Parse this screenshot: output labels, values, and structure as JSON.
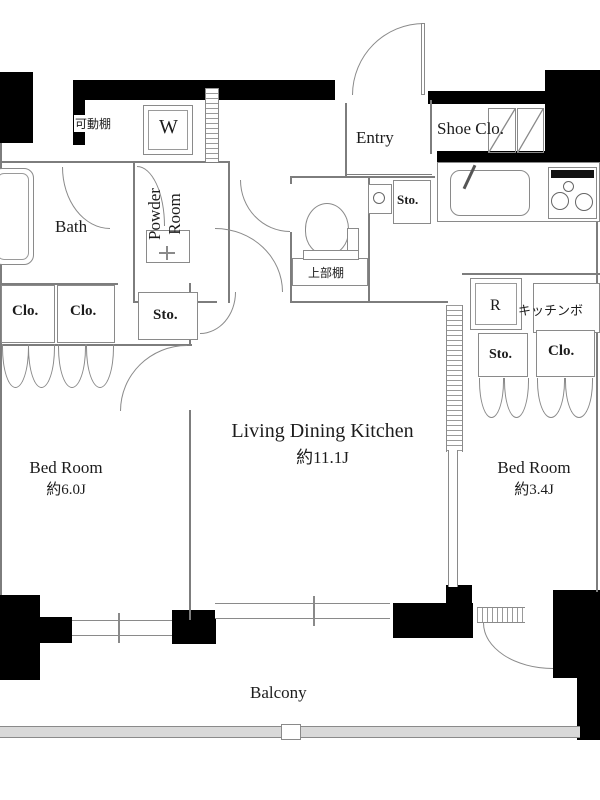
{
  "floorplan": {
    "rooms": {
      "ldk": {
        "name": "Living Dining Kitchen",
        "size": "約11.1J"
      },
      "bedroom_left": {
        "name": "Bed Room",
        "size": "約6.0J"
      },
      "bedroom_right": {
        "name": "Bed Room",
        "size": "約3.4J"
      },
      "bath": {
        "name": "Bath"
      },
      "powder_room": {
        "name": "Powder Room"
      },
      "entry": {
        "name": "Entry"
      },
      "shoe_closet": {
        "name": "Shoe Clo."
      },
      "balcony": {
        "name": "Balcony"
      }
    },
    "labels": {
      "movable_shelf": "可動棚",
      "washing_machine": "W",
      "upper_shelf": "上部棚",
      "storage": "Sto.",
      "closet": "Clo.",
      "refrigerator": "R",
      "kitchen_board": "キッチンボ"
    },
    "colors": {
      "wall_black": "#000000",
      "line_gray": "#8a8a8a",
      "background": "#ffffff",
      "text": "#1c1c1c"
    }
  }
}
